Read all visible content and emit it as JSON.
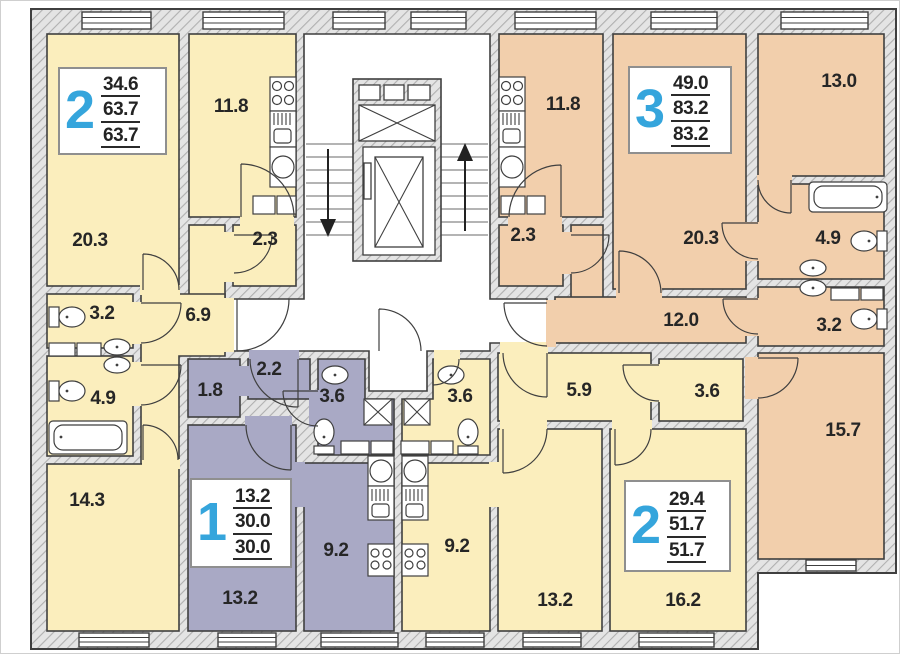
{
  "meta": {
    "type": "apartment-floor-plan"
  },
  "palette": {
    "apartment_yellow": "#FBEEBD",
    "apartment_tan": "#F2CFAC",
    "apartment_purple": "#A9A9C5",
    "wall_hatch_bg": "#e4e4e4",
    "wall_hatch_line": "#b0b0b0",
    "line": "#3f3f3f",
    "accent_blue": "#35A5DC"
  },
  "apartments": [
    {
      "name": "two-room-left",
      "number": "2",
      "areas": [
        "34.6",
        "63.7",
        "63.7"
      ]
    },
    {
      "name": "three-room-right",
      "number": "3",
      "areas": [
        "49.0",
        "83.2",
        "83.2"
      ]
    },
    {
      "name": "one-room-center",
      "number": "1",
      "areas": [
        "13.2",
        "30.0",
        "30.0"
      ]
    },
    {
      "name": "two-room-bottom-right",
      "number": "2",
      "areas": [
        "29.4",
        "51.7",
        "51.7"
      ]
    }
  ],
  "rooms": {
    "r20_3_left": "20.3",
    "k11_8_left": "11.8",
    "e2_3_left": "2.3",
    "wc3_2_left": "3.2",
    "h6_9": "6.9",
    "b4_9_left": "4.9",
    "r14_3": "14.3",
    "r1_8": "1.8",
    "c2_2": "2.2",
    "b3_6_purple": "3.6",
    "k9_2_purple": "9.2",
    "r13_2_purple": "13.2",
    "b3_6_yellow": "3.6",
    "k9_2_yellow": "9.2",
    "h5_9": "5.9",
    "c3_6_closet": "3.6",
    "r13_2_yellow": "13.2",
    "r16_2": "16.2",
    "k11_8_tan": "11.8",
    "e2_3_tan": "2.3",
    "r20_3_tan": "20.3",
    "r13_0": "13.0",
    "h12_0": "12.0",
    "b4_9_tan": "4.9",
    "wc3_2_tan": "3.2",
    "r15_7": "15.7"
  },
  "features": {
    "elevator": "elevator-shaft",
    "stairs_down": "arrow-down",
    "stairs_up": "arrow-up"
  }
}
